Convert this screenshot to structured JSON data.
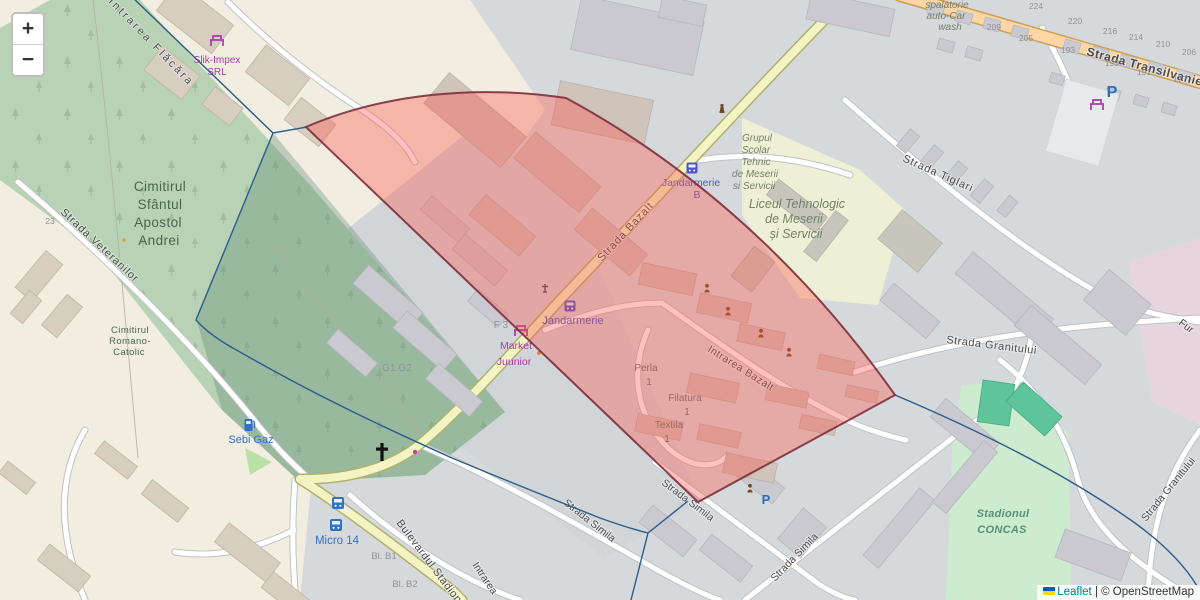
{
  "controls": {
    "zoom_in": "+",
    "zoom_out": "−"
  },
  "attribution": {
    "leaflet": "Leaflet",
    "separator": " | ",
    "copyright": "© OpenStreetMap"
  },
  "colors": {
    "selection_fill": "#ff5248",
    "selection_stroke": "#7d2d3c",
    "boundary_line": "#2a5d8c",
    "cemetery_green": "#b7d2b4",
    "stadium_green": "#cdebcf",
    "primary_road": "#fcd6a4",
    "secondary_road": "#f3f4c3",
    "transit_blue": "#4d55c8",
    "shop_purple": "#ac39ac"
  },
  "labels": {
    "intrarea_flacara": "Intrarea Flăcăra",
    "strada_veteranilor": "Strada Veteranilor",
    "strada_bazalt": "Strada Bazalt",
    "strada_transilvaniei": "Strada Transilvaniei",
    "strada_tiglari": "Strada Tiglari",
    "strada_granitului": "Strada Granitului",
    "strada_granitului_edge": "Strada Granitului",
    "fur_partial": "Fur",
    "intrarea_bazalt": "Intrarea Bazalt",
    "strada_simila": "Strada Simila",
    "bulevardul_stadionului": "Bulevardul Stadionului",
    "intrarea_partial": "Intrarea",
    "cimitirul_sfantul": {
      "l1": "Cimitirul",
      "l2": "Sfântul",
      "l3": "Apostol",
      "l4": "Andrei"
    },
    "cimitirul_romano": {
      "l1": "Cimitirul",
      "l2": "Romano-",
      "l3": "Catolic"
    },
    "slik_impex": {
      "l1": "Slik-Impex",
      "l2": "SRL"
    },
    "market_juunior": {
      "l1": "Market",
      "l2": "Juunior"
    },
    "jandarmerie": "Jandarmerie",
    "jandarmerie_b": {
      "l1": "Jandarmerie",
      "l2": "B"
    },
    "grupul_scolar": {
      "l1": "Grupul",
      "l2": "Scolar",
      "l3": "Tehnic",
      "l4": "de Meserii",
      "l5": "si Servicii"
    },
    "liceul": {
      "l1": "Liceul Tehnologic",
      "l2": "de Meserii",
      "l3": "și Servicii"
    },
    "spalatorie": {
      "l1": "spalatorie",
      "l2": "auto-Car",
      "l3": "wash"
    },
    "perla": {
      "l1": "Perla",
      "l2": "1"
    },
    "filatura": {
      "l1": "Filatura",
      "l2": "1"
    },
    "textila": {
      "l1": "Textila",
      "l2": "1"
    },
    "stadionul_concas": {
      "l1": "Stadionul",
      "l2": "CONCAS"
    },
    "micro_14": "Micro 14",
    "sebi_gaz": "Sebi Gaz",
    "bl_b1": "Bl. B1",
    "bl_b2": "Bl. B2",
    "g1_g2": "G1.G2",
    "f3": "F 3",
    "parking": "P"
  },
  "house_numbers": [
    "224",
    "220",
    "209",
    "205",
    "216",
    "214",
    "210",
    "206",
    "193",
    "193",
    "191",
    "177",
    "23"
  ]
}
